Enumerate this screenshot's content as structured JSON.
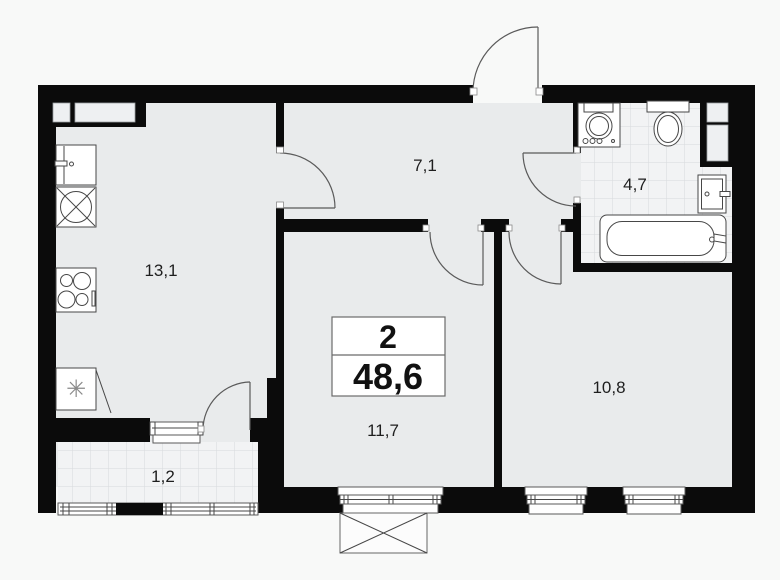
{
  "plan": {
    "summary": {
      "rooms_count": "2",
      "total_area": "48,6"
    },
    "rooms": [
      {
        "name": "kitchen-living",
        "area": "13,1"
      },
      {
        "name": "hallway",
        "area": "7,1"
      },
      {
        "name": "bathroom",
        "area": "4,7"
      },
      {
        "name": "bedroom",
        "area": "10,8"
      },
      {
        "name": "room",
        "area": "11,7"
      },
      {
        "name": "balcony",
        "area": "1,2"
      }
    ],
    "symbols": {
      "freezer": "✳"
    },
    "colors": {
      "wall": "#0b0b0b",
      "floor": "#e9ebec",
      "tile": "#f2f3f4",
      "tile_grid": "#d7dadc",
      "background": "#f8f9f8",
      "line": "#474747"
    }
  }
}
